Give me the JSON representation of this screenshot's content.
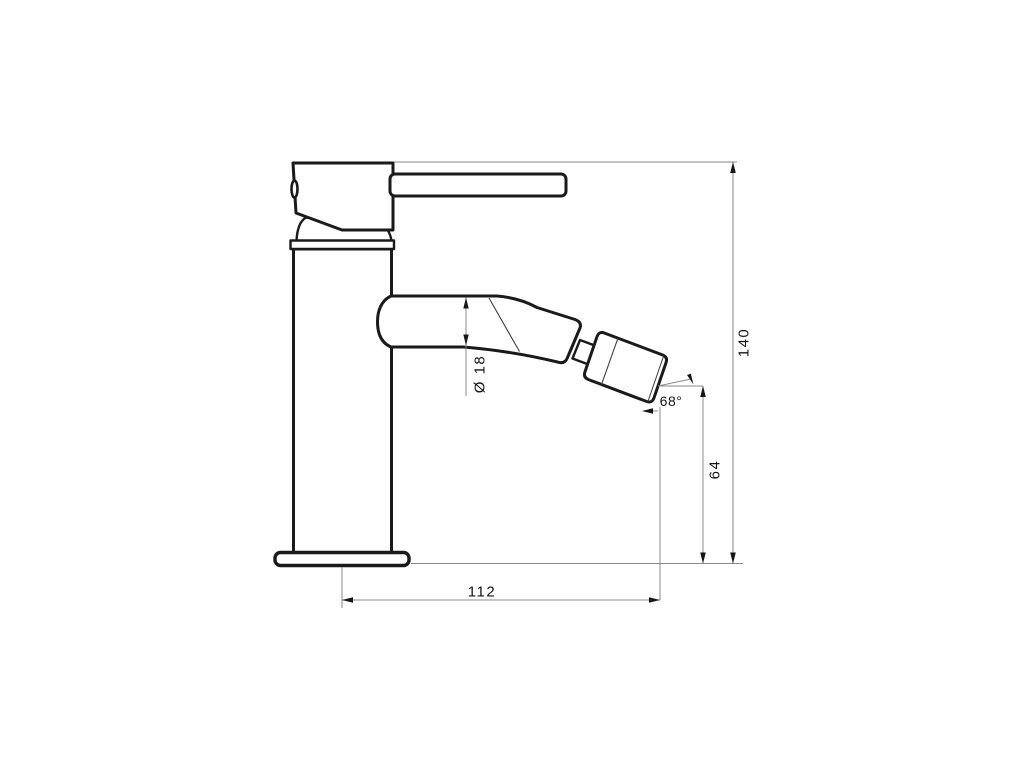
{
  "page": {
    "background": "#ffffff"
  },
  "drawing": {
    "subject": "single-lever bidet mixer faucet, side elevation technical drawing",
    "colors": {
      "outline": "#1a1a1a",
      "dimension_line": "#8a8a8a",
      "label": "#141414"
    },
    "labels": {
      "overall_height": "140",
      "outlet_height": "64",
      "reach": "112",
      "spout_diameter": "Ø 18",
      "outlet_angle": "68°"
    }
  }
}
